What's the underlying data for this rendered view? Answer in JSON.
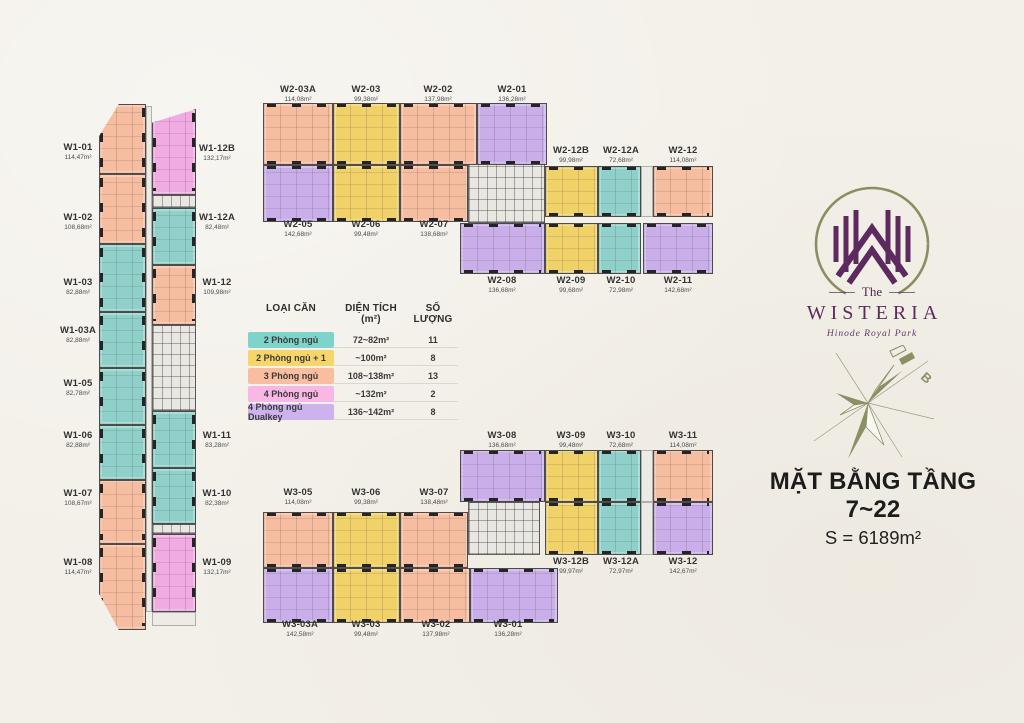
{
  "page": {
    "background": "#f3f0e9"
  },
  "title": {
    "line1": "MẶT BẰNG TẦNG 7~22",
    "line2": "S = 6189m²"
  },
  "logo": {
    "the": "The",
    "name": "WISTERIA",
    "subtitle": "Hinode Royal Park"
  },
  "compass": {
    "north_label": "B"
  },
  "legend": {
    "headers": [
      "LOẠI CĂN",
      "DIỆN TÍCH (m²)",
      "SỐ LƯỢNG"
    ],
    "rows": [
      {
        "label": "2 Phòng ngủ",
        "area": "72~82m²",
        "qty": "11",
        "color": "#7ed3ca"
      },
      {
        "label": "2 Phòng ngủ + 1",
        "area": "~100m²",
        "qty": "8",
        "color": "#f6d56a"
      },
      {
        "label": "3 Phòng ngủ",
        "area": "108~138m²",
        "qty": "13",
        "color": "#f9bda0"
      },
      {
        "label": "4 Phòng ngủ",
        "area": "~132m²",
        "qty": "2",
        "color": "#f8b7e4"
      },
      {
        "label": "4 Phòng ngủ Dualkey",
        "area": "136~142m²",
        "qty": "8",
        "color": "#cdb2ed"
      }
    ]
  },
  "type_colors": {
    "2pn": "#8fd1ca",
    "2pn1": "#f0d269",
    "3pn": "#f7bda0",
    "4pn": "#f2abe2",
    "4pnd": "#c9aeea"
  },
  "buildings": [
    {
      "id": "W1",
      "units": [
        {
          "name": "W1-01",
          "area": "114,47m²",
          "type": "3pn",
          "x": 99,
          "y": 104,
          "w": 47,
          "h": 70,
          "lx": 78,
          "ly": 152,
          "ticks": "v",
          "clip": "polygon(42% 0,100% 0,100% 100%,0 100%,0 46%)"
        },
        {
          "name": "W1-02",
          "area": "108,68m²",
          "type": "3pn",
          "x": 99,
          "y": 174,
          "w": 47,
          "h": 70,
          "lx": 78,
          "ly": 222,
          "ticks": "v"
        },
        {
          "name": "W1-03",
          "area": "82,88m²",
          "type": "2pn",
          "x": 99,
          "y": 244,
          "w": 47,
          "h": 68,
          "lx": 78,
          "ly": 287,
          "ticks": "v"
        },
        {
          "name": "W1-03A",
          "area": "82,88m²",
          "type": "2pn",
          "x": 99,
          "y": 312,
          "w": 47,
          "h": 56,
          "lx": 78,
          "ly": 335,
          "ticks": "v"
        },
        {
          "name": "W1-05",
          "area": "82,78m²",
          "type": "2pn",
          "x": 99,
          "y": 368,
          "w": 47,
          "h": 57,
          "lx": 78,
          "ly": 388,
          "ticks": "v"
        },
        {
          "name": "W1-06",
          "area": "82,88m²",
          "type": "2pn",
          "x": 99,
          "y": 425,
          "w": 47,
          "h": 55,
          "lx": 78,
          "ly": 440,
          "ticks": "v"
        },
        {
          "name": "W1-07",
          "area": "108,67m²",
          "type": "3pn",
          "x": 99,
          "y": 480,
          "w": 47,
          "h": 64,
          "lx": 78,
          "ly": 498,
          "ticks": "v"
        },
        {
          "name": "W1-08",
          "area": "114,47m²",
          "type": "3pn",
          "x": 99,
          "y": 544,
          "w": 47,
          "h": 86,
          "lx": 78,
          "ly": 567,
          "ticks": "v",
          "clip": "polygon(0 0,100% 0,100% 100%,42% 100%,0 58%)"
        },
        {
          "name": "W1-12B",
          "area": "132,17m²",
          "type": "4pn",
          "x": 152,
          "y": 109,
          "w": 44,
          "h": 86,
          "lx": 217,
          "ly": 153,
          "ticks": "v",
          "clip": "polygon(0 16%,100% 0,100% 100%,0 100%)"
        },
        {
          "name": "W1-12A",
          "area": "82,48m²",
          "type": "2pn",
          "x": 152,
          "y": 208,
          "w": 44,
          "h": 57,
          "lx": 217,
          "ly": 222,
          "ticks": "v"
        },
        {
          "name": "W1-12",
          "area": "109,98m²",
          "type": "3pn",
          "x": 152,
          "y": 265,
          "w": 44,
          "h": 60,
          "lx": 217,
          "ly": 287,
          "ticks": "v"
        },
        {
          "name": "W1-11",
          "area": "83,28m²",
          "type": "2pn",
          "x": 152,
          "y": 411,
          "w": 44,
          "h": 57,
          "lx": 217,
          "ly": 440,
          "ticks": "v"
        },
        {
          "name": "W1-10",
          "area": "82,38m²",
          "type": "2pn",
          "x": 152,
          "y": 468,
          "w": 44,
          "h": 56,
          "lx": 217,
          "ly": 498,
          "ticks": "v"
        },
        {
          "name": "W1-09",
          "area": "132,17m²",
          "type": "4pn",
          "x": 152,
          "y": 534,
          "w": 44,
          "h": 78,
          "lx": 217,
          "ly": 567,
          "ticks": "v"
        }
      ]
    },
    {
      "id": "W2",
      "units": [
        {
          "name": "W2-03A",
          "area": "114,08m²",
          "type": "3pn",
          "x": 263,
          "y": 103,
          "w": 70,
          "h": 62,
          "lx": 298,
          "ly": 94,
          "ticks": "h"
        },
        {
          "name": "W2-03",
          "area": "99,38m²",
          "type": "2pn1",
          "x": 333,
          "y": 103,
          "w": 67,
          "h": 62,
          "lx": 366,
          "ly": 94,
          "ticks": "h"
        },
        {
          "name": "W2-02",
          "area": "137,98m²",
          "type": "3pn",
          "x": 400,
          "y": 103,
          "w": 77,
          "h": 62,
          "lx": 438,
          "ly": 94,
          "ticks": "h"
        },
        {
          "name": "W2-01",
          "area": "136,28m²",
          "type": "4pnd",
          "x": 477,
          "y": 103,
          "w": 70,
          "h": 62,
          "lx": 512,
          "ly": 94,
          "ticks": "h"
        },
        {
          "name": "W2-05",
          "area": "142,68m²",
          "type": "4pnd",
          "x": 263,
          "y": 165,
          "w": 70,
          "h": 57,
          "lx": 298,
          "ly": 229,
          "ticks": "h"
        },
        {
          "name": "W2-06",
          "area": "99,48m²",
          "type": "2pn1",
          "x": 333,
          "y": 165,
          "w": 67,
          "h": 57,
          "lx": 366,
          "ly": 229,
          "ticks": "h"
        },
        {
          "name": "W2-07",
          "area": "138,68m²",
          "type": "3pn",
          "x": 400,
          "y": 165,
          "w": 68,
          "h": 57,
          "lx": 434,
          "ly": 229,
          "ticks": "h"
        },
        {
          "name": "W2-12B",
          "area": "99,98m²",
          "type": "2pn1",
          "x": 545,
          "y": 166,
          "w": 53,
          "h": 51,
          "lx": 571,
          "ly": 155,
          "ticks": "h"
        },
        {
          "name": "W2-12A",
          "area": "72,68m²",
          "type": "2pn",
          "x": 598,
          "y": 166,
          "w": 43,
          "h": 51,
          "lx": 621,
          "ly": 155,
          "ticks": "h"
        },
        {
          "name": "W2-12",
          "area": "114,08m²",
          "type": "3pn",
          "x": 653,
          "y": 166,
          "w": 60,
          "h": 51,
          "lx": 683,
          "ly": 155,
          "ticks": "h"
        },
        {
          "name": "W2-08",
          "area": "136,68m²",
          "type": "4pnd",
          "x": 460,
          "y": 223,
          "w": 85,
          "h": 51,
          "lx": 502,
          "ly": 285,
          "ticks": "h"
        },
        {
          "name": "W2-09",
          "area": "99,68m²",
          "type": "2pn1",
          "x": 545,
          "y": 223,
          "w": 53,
          "h": 51,
          "lx": 571,
          "ly": 285,
          "ticks": "h"
        },
        {
          "name": "W2-10",
          "area": "72,98m²",
          "type": "2pn",
          "x": 598,
          "y": 223,
          "w": 43,
          "h": 51,
          "lx": 621,
          "ly": 285,
          "ticks": "h"
        },
        {
          "name": "W2-11",
          "area": "142,68m²",
          "type": "4pnd",
          "x": 643,
          "y": 223,
          "w": 70,
          "h": 51,
          "lx": 678,
          "ly": 285,
          "ticks": "h"
        }
      ]
    },
    {
      "id": "W3",
      "units": [
        {
          "name": "W3-08",
          "area": "136,68m²",
          "type": "4pnd",
          "x": 460,
          "y": 450,
          "w": 85,
          "h": 52,
          "lx": 502,
          "ly": 440,
          "ticks": "h"
        },
        {
          "name": "W3-09",
          "area": "99,48m²",
          "type": "2pn1",
          "x": 545,
          "y": 450,
          "w": 53,
          "h": 52,
          "lx": 571,
          "ly": 440,
          "ticks": "h"
        },
        {
          "name": "W3-10",
          "area": "72,68m²",
          "type": "2pn",
          "x": 598,
          "y": 450,
          "w": 43,
          "h": 52,
          "lx": 621,
          "ly": 440,
          "ticks": "h"
        },
        {
          "name": "W3-11",
          "area": "114,08m²",
          "type": "3pn",
          "x": 653,
          "y": 450,
          "w": 60,
          "h": 52,
          "lx": 683,
          "ly": 440,
          "ticks": "h"
        },
        {
          "name": "W3-12B",
          "area": "99,97m²",
          "type": "2pn1",
          "x": 545,
          "y": 502,
          "w": 53,
          "h": 53,
          "lx": 571,
          "ly": 566,
          "ticks": "h"
        },
        {
          "name": "W3-12A",
          "area": "72,97m²",
          "type": "2pn",
          "x": 598,
          "y": 502,
          "w": 43,
          "h": 53,
          "lx": 621,
          "ly": 566,
          "ticks": "h"
        },
        {
          "name": "W3-12",
          "area": "142,67m²",
          "type": "4pnd",
          "x": 653,
          "y": 502,
          "w": 60,
          "h": 53,
          "lx": 683,
          "ly": 566,
          "ticks": "h"
        },
        {
          "name": "W3-05",
          "area": "114,08m²",
          "type": "3pn",
          "x": 263,
          "y": 512,
          "w": 70,
          "h": 56,
          "lx": 298,
          "ly": 497,
          "ticks": "h"
        },
        {
          "name": "W3-06",
          "area": "99,38m²",
          "type": "2pn1",
          "x": 333,
          "y": 512,
          "w": 67,
          "h": 56,
          "lx": 366,
          "ly": 497,
          "ticks": "h"
        },
        {
          "name": "W3-07",
          "area": "138,48m²",
          "type": "3pn",
          "x": 400,
          "y": 512,
          "w": 68,
          "h": 56,
          "lx": 434,
          "ly": 497,
          "ticks": "h"
        },
        {
          "name": "W3-03A",
          "area": "142,58m²",
          "type": "4pnd",
          "x": 263,
          "y": 568,
          "w": 70,
          "h": 55,
          "lx": 300,
          "ly": 629,
          "ticks": "h"
        },
        {
          "name": "W3-03",
          "area": "99,48m²",
          "type": "2pn1",
          "x": 333,
          "y": 568,
          "w": 67,
          "h": 55,
          "lx": 366,
          "ly": 629,
          "ticks": "h"
        },
        {
          "name": "W3-02",
          "area": "137,98m²",
          "type": "3pn",
          "x": 400,
          "y": 568,
          "w": 70,
          "h": 55,
          "lx": 436,
          "ly": 629,
          "ticks": "h"
        },
        {
          "name": "W3-01",
          "area": "136,28m²",
          "type": "4pnd",
          "x": 470,
          "y": 568,
          "w": 88,
          "h": 55,
          "lx": 508,
          "ly": 629,
          "ticks": "h"
        }
      ]
    }
  ],
  "cores": [
    {
      "kind": "corridor",
      "x": 146,
      "y": 106,
      "w": 6,
      "h": 506
    },
    {
      "kind": "core",
      "x": 152,
      "y": 195,
      "w": 44,
      "h": 13
    },
    {
      "kind": "core",
      "x": 152,
      "y": 325,
      "w": 44,
      "h": 86
    },
    {
      "kind": "core",
      "x": 152,
      "y": 524,
      "w": 44,
      "h": 10
    },
    {
      "kind": "corridor",
      "x": 152,
      "y": 612,
      "w": 44,
      "h": 14
    },
    {
      "kind": "core",
      "x": 468,
      "y": 163,
      "w": 77,
      "h": 60
    },
    {
      "kind": "corridor",
      "x": 641,
      "y": 166,
      "w": 12,
      "h": 51
    },
    {
      "kind": "core",
      "x": 468,
      "y": 502,
      "w": 72,
      "h": 53
    },
    {
      "kind": "corridor",
      "x": 641,
      "y": 450,
      "w": 12,
      "h": 52
    },
    {
      "kind": "corridor",
      "x": 641,
      "y": 502,
      "w": 12,
      "h": 53
    }
  ]
}
